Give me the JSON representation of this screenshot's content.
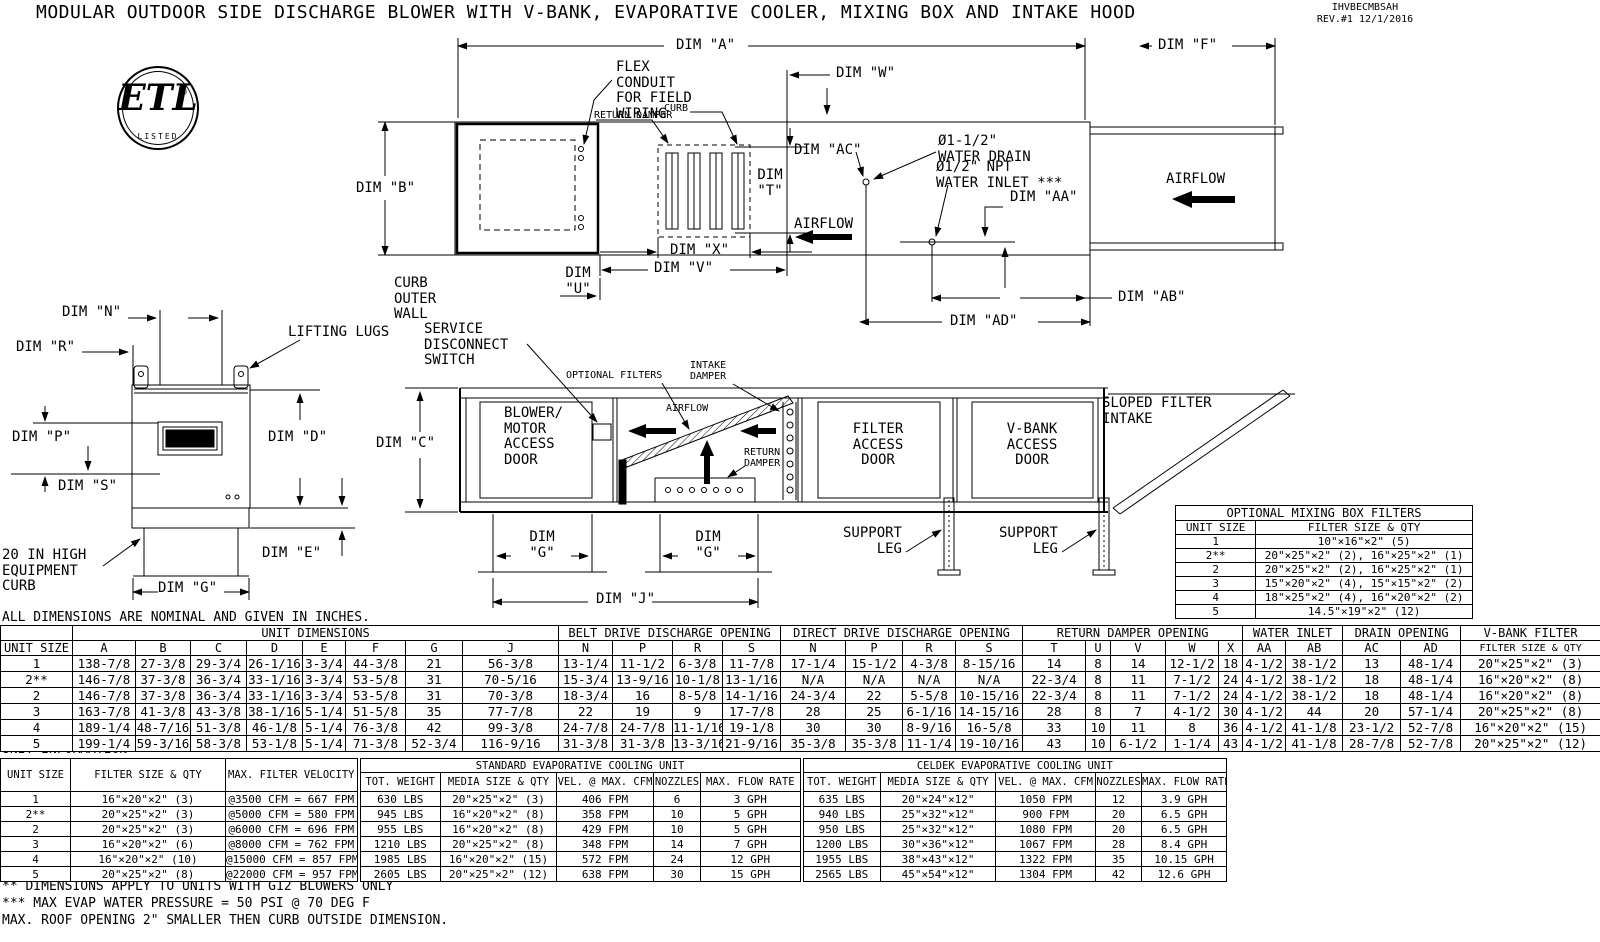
{
  "colors": {
    "ink": "#000000",
    "paper": "#ffffff"
  },
  "header": {
    "title": "MODULAR OUTDOOR SIDE DISCHARGE BLOWER WITH V-BANK, EVAPORATIVE COOLER, MIXING BOX AND INTAKE HOOD",
    "doc_code": "IHVBECMBSAH",
    "revision": "REV.#1 12/1/2016",
    "logo": {
      "mark": "ETL",
      "reg": "®",
      "listed": "LISTED"
    }
  },
  "plan": {
    "dim_a": "DIM \"A\"",
    "dim_f": "DIM \"F\"",
    "dim_w": "DIM \"W\"",
    "dim_b": "DIM \"B\"",
    "dim_t": "DIM\n\"T\"",
    "dim_x": "DIM \"X\"",
    "dim_v": "DIM \"V\"",
    "dim_u": "DIM\n\"U\"",
    "dim_ac": "DIM \"AC\"",
    "dim_aa": "DIM \"AA\"",
    "dim_ab": "DIM \"AB\"",
    "dim_ad": "DIM \"AD\"",
    "flex_conduit": "FLEX\nCONDUIT\nFOR FIELD\nWIRING",
    "return_damper": "RETURN DAMPER",
    "curb": "CURB",
    "water_drain": "Ø1-1/2\"\nWATER DRAIN",
    "water_inlet": "Ø1/2\" NPT\nWATER INLET ***",
    "airflow": "AIRFLOW",
    "curb_outer_wall": "CURB\nOUTER\nWALL"
  },
  "front": {
    "dim_n": "DIM \"N\"",
    "dim_r": "DIM \"R\"",
    "dim_p": "DIM \"P\"",
    "dim_s": "DIM \"S\"",
    "dim_d": "DIM \"D\"",
    "dim_e": "DIM \"E\"",
    "dim_g": "DIM \"G\"",
    "lifting_lugs": "LIFTING LUGS",
    "equipment_curb": "20 IN HIGH\nEQUIPMENT\nCURB"
  },
  "side": {
    "service_disconnect": "SERVICE\nDISCONNECT\nSWITCH",
    "blower_door": "BLOWER/\nMOTOR\nACCESS\nDOOR",
    "dim_c": "DIM \"C\"",
    "optional_filters": "OPTIONAL FILTERS",
    "intake_damper": "INTAKE\nDAMPER",
    "airflow": "AIRFLOW",
    "return_damper": "RETURN\nDAMPER",
    "filter_door": "FILTER\nACCESS\nDOOR",
    "vbank_door": "V-BANK\nACCESS\nDOOR",
    "sloped_intake": "SLOPED FILTER\nINTAKE",
    "support_leg": "SUPPORT\nLEG",
    "dim_g": "DIM\n\"G\"",
    "dim_j": "DIM \"J\""
  },
  "mixing_box_filters": {
    "col_widths": [
      80,
      216
    ],
    "header_rows": [
      [
        {
          "t": "OPTIONAL MIXING BOX FILTERS",
          "c": 2
        }
      ],
      [
        "UNIT SIZE",
        "FILTER SIZE & QTY"
      ]
    ],
    "rows": [
      [
        "1",
        "10\"×16\"×2\" (5)"
      ],
      [
        "2**",
        "20\"×25\"×2\" (2), 16\"×25\"×2\" (1)"
      ],
      [
        "2",
        "20\"×25\"×2\" (2), 16\"×25\"×2\" (1)"
      ],
      [
        "3",
        "15\"×20\"×2\" (4), 15\"×15\"×2\" (2)"
      ],
      [
        "4",
        "18\"×25\"×2\" (4), 16\"×20\"×2\" (2)"
      ],
      [
        "5",
        "14.5\"×19\"×2\" (12)"
      ]
    ]
  },
  "unit_dimensions": {
    "col_widths": [
      72,
      63,
      55,
      56,
      56,
      43,
      60,
      57,
      96,
      54,
      60,
      50,
      58,
      65,
      57,
      53,
      67,
      63,
      25,
      55,
      53,
      24,
      43,
      57,
      58,
      60,
      140
    ],
    "header_rows": [
      [
        {
          "t": ""
        },
        {
          "t": "UNIT DIMENSIONS",
          "c": 8
        },
        {
          "t": "BELT DRIVE DISCHARGE OPENING",
          "c": 4
        },
        {
          "t": "DIRECT DRIVE DISCHARGE OPENING",
          "c": 4
        },
        {
          "t": "RETURN DAMPER OPENING",
          "c": 5
        },
        {
          "t": "WATER INLET",
          "c": 2
        },
        {
          "t": "DRAIN OPENING",
          "c": 2
        },
        {
          "t": "V-BANK FILTER"
        }
      ],
      [
        "UNIT SIZE",
        "A",
        "B",
        "C",
        "D",
        "E",
        "F",
        "G",
        "J",
        "N",
        "P",
        "R",
        "S",
        "N",
        "P",
        "R",
        "S",
        "T",
        "U",
        "V",
        "W",
        "X",
        "AA",
        "AB",
        "AC",
        "AD",
        "FILTER SIZE & QTY"
      ]
    ],
    "rows": [
      [
        "1",
        "138-7/8",
        "27-3/8",
        "29-3/4",
        "26-1/16",
        "3-3/4",
        "44-3/8",
        "21",
        "56-3/8",
        "13-1/4",
        "11-1/2",
        "6-3/8",
        "11-7/8",
        "17-1/4",
        "15-1/2",
        "4-3/8",
        "8-15/16",
        "14",
        "8",
        "14",
        "12-1/2",
        "18",
        "4-1/2",
        "38-1/2",
        "13",
        "48-1/4",
        "20\"×25\"×2\" (3)"
      ],
      [
        "2**",
        "146-7/8",
        "37-3/8",
        "36-3/4",
        "33-1/16",
        "3-3/4",
        "53-5/8",
        "31",
        "70-5/16",
        "15-3/4",
        "13-9/16",
        "10-1/8",
        "13-1/16",
        "N/A",
        "N/A",
        "N/A",
        "N/A",
        "22-3/4",
        "8",
        "11",
        "7-1/2",
        "24",
        "4-1/2",
        "38-1/2",
        "18",
        "48-1/4",
        "16\"×20\"×2\" (8)"
      ],
      [
        "2",
        "146-7/8",
        "37-3/8",
        "36-3/4",
        "33-1/16",
        "3-3/4",
        "53-5/8",
        "31",
        "70-3/8",
        "18-3/4",
        "16",
        "8-5/8",
        "14-1/16",
        "24-3/4",
        "22",
        "5-5/8",
        "10-15/16",
        "22-3/4",
        "8",
        "11",
        "7-1/2",
        "24",
        "4-1/2",
        "38-1/2",
        "18",
        "48-1/4",
        "16\"×20\"×2\" (8)"
      ],
      [
        "3",
        "163-7/8",
        "41-3/8",
        "43-3/8",
        "38-1/16",
        "5-1/4",
        "51-5/8",
        "35",
        "77-7/8",
        "22",
        "19",
        "9",
        "17-7/8",
        "28",
        "25",
        "6-1/16",
        "14-15/16",
        "28",
        "8",
        "7",
        "4-1/2",
        "30",
        "4-1/2",
        "44",
        "20",
        "57-1/4",
        "20\"×25\"×2\" (8)"
      ],
      [
        "4",
        "189-1/4",
        "48-7/16",
        "51-3/8",
        "46-1/8",
        "5-1/4",
        "76-3/8",
        "42",
        "99-3/8",
        "24-7/8",
        "24-7/8",
        "11-1/16",
        "19-1/8",
        "30",
        "30",
        "8-9/16",
        "16-5/8",
        "33",
        "10",
        "11",
        "8",
        "36",
        "4-1/2",
        "41-1/8",
        "23-1/2",
        "52-7/8",
        "16\"×20\"×2\" (15)"
      ],
      [
        "5",
        "199-1/4",
        "59-3/16",
        "58-3/8",
        "53-1/8",
        "5-1/4",
        "71-3/8",
        "52-3/4",
        "116-9/16",
        "31-3/8",
        "31-3/8",
        "13-3/16",
        "21-9/16",
        "35-3/8",
        "35-3/8",
        "11-1/4",
        "19-10/16",
        "43",
        "10",
        "6-1/2",
        "1-1/4",
        "43",
        "4-1/2",
        "41-1/8",
        "28-7/8",
        "52-7/8",
        "20\"×25\"×2\" (12)"
      ]
    ]
  },
  "unit_information": {
    "title": "UNIT INFORMATION",
    "col_widths": [
      70,
      155,
      133,
      82,
      116,
      97,
      47,
      101,
      79,
      115,
      100,
      46,
      85
    ],
    "header_rows": [
      [
        {
          "t": "UNIT SIZE",
          "r": 2
        },
        {
          "t": "FILTER SIZE & QTY",
          "r": 2
        },
        {
          "t": "MAX. FILTER VELOCITY",
          "r": 2
        },
        {
          "t": "STANDARD EVAPORATIVE COOLING UNIT",
          "c": 5
        },
        {
          "t": "CELDEK EVAPORATIVE COOLING UNIT",
          "c": 5
        }
      ],
      [
        "TOT. WEIGHT",
        "MEDIA SIZE & QTY",
        "VEL. @ MAX. CFM",
        "NOZZLES",
        "MAX. FLOW RATE",
        "TOT. WEIGHT",
        "MEDIA SIZE & QTY",
        "VEL. @ MAX. CFM",
        "NOZZLES",
        "MAX. FLOW RATE"
      ]
    ],
    "rows": [
      [
        "1",
        "16\"×20\"×2\" (3)",
        "@3500 CFM = 667 FPM",
        "630 LBS",
        "20\"×25\"×2\" (3)",
        "406 FPM",
        "6",
        "3 GPH",
        "635 LBS",
        "20\"×24\"×12\"",
        "1050 FPM",
        "12",
        "3.9 GPH"
      ],
      [
        "2**",
        "20\"×25\"×2\" (3)",
        "@5000 CFM = 580 FPM",
        "945 LBS",
        "16\"×20\"×2\" (8)",
        "358 FPM",
        "10",
        "5 GPH",
        "940 LBS",
        "25\"×32\"×12\"",
        "900 FPM",
        "20",
        "6.5 GPH"
      ],
      [
        "2",
        "20\"×25\"×2\" (3)",
        "@6000 CFM = 696 FPM",
        "955 LBS",
        "16\"×20\"×2\" (8)",
        "429 FPM",
        "10",
        "5 GPH",
        "950 LBS",
        "25\"×32\"×12\"",
        "1080 FPM",
        "20",
        "6.5 GPH"
      ],
      [
        "3",
        "16\"×20\"×2\" (6)",
        "@8000 CFM = 762 FPM",
        "1210 LBS",
        "20\"×25\"×2\" (8)",
        "348 FPM",
        "14",
        "7 GPH",
        "1200 LBS",
        "30\"×36\"×12\"",
        "1067 FPM",
        "28",
        "8.4 GPH"
      ],
      [
        "4",
        "16\"×20\"×2\" (10)",
        "@15000 CFM = 857 FPM",
        "1985 LBS",
        "16\"×20\"×2\" (15)",
        "572 FPM",
        "24",
        "12 GPH",
        "1955 LBS",
        "38\"×43\"×12\"",
        "1322 FPM",
        "35",
        "10.15 GPH"
      ],
      [
        "5",
        "20\"×25\"×2\" (8)",
        "@22000 CFM = 957 FPM",
        "2605 LBS",
        "20\"×25\"×2\" (12)",
        "638 FPM",
        "30",
        "15 GPH",
        "2565 LBS",
        "45\"×54\"×12\"",
        "1304 FPM",
        "42",
        "12.6 GPH"
      ]
    ]
  },
  "notes": {
    "dimensions_note": "ALL DIMENSIONS ARE NOMINAL AND GIVEN IN INCHES.",
    "footnotes": [
      "** DIMENSIONS APPLY TO UNITS WITH G12 BLOWERS ONLY",
      "*** MAX EVAP WATER PRESSURE = 50 PSI @ 70 DEG F",
      "MAX. ROOF OPENING 2\" SMALLER THEN CURB OUTSIDE DIMENSION."
    ]
  }
}
